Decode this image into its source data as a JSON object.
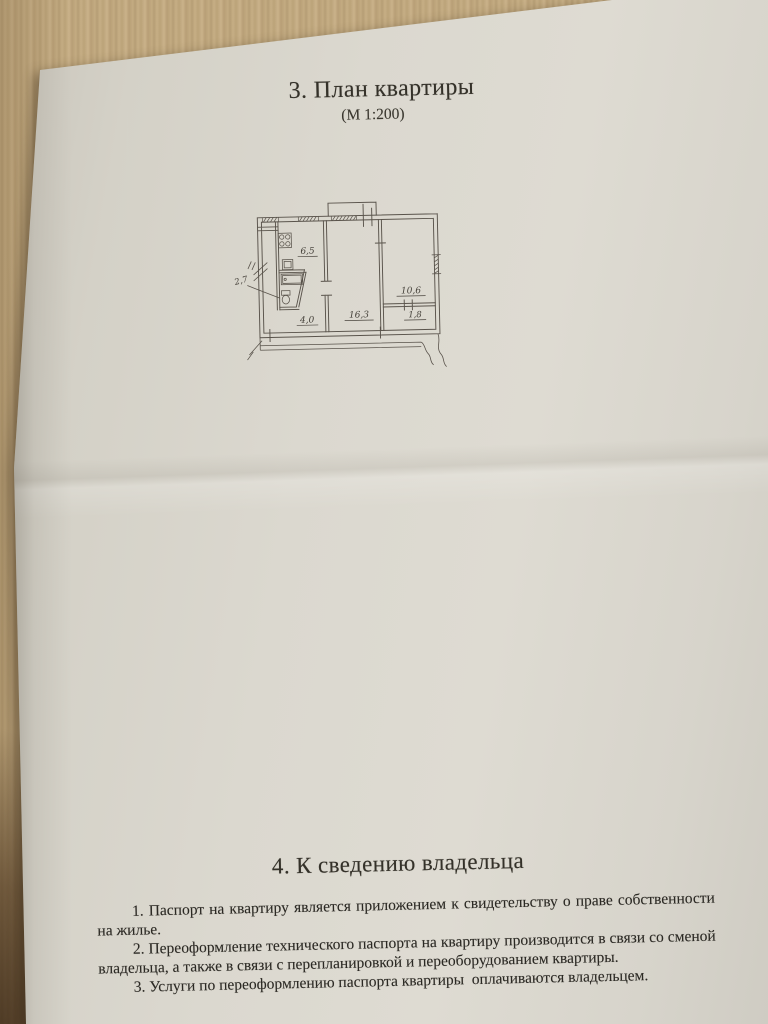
{
  "document": {
    "section_plan": {
      "heading": "3. План квартиры",
      "scale": "(М 1:200)"
    },
    "floor_plan": {
      "rooms": [
        {
          "name": "kitchen",
          "area": "6,5"
        },
        {
          "name": "bathroom",
          "area": "2,7"
        },
        {
          "name": "hallway",
          "area": "4,0"
        },
        {
          "name": "living-room",
          "area": "16,3"
        },
        {
          "name": "bedroom",
          "area": "10,6"
        },
        {
          "name": "storage",
          "area": "1,8"
        }
      ]
    },
    "section_owner": {
      "heading": "4. К сведению владельца",
      "paragraphs": [
        "1. Паспорт на квартиру является приложением к свидетельству о праве собственности на жилье.",
        "2. Переоформление технического паспорта на квартиру производится в связи со сменой владельца, а также в связи с перепланировкой и переоборудованием квартиры.",
        "3. Услуги по переоформлению паспорта квартиры  оплачиваются владельцем."
      ]
    }
  },
  "colors": {
    "paper": "#d8d5cc",
    "wood": "#bfa77e",
    "wood_dark": "#4a3420",
    "ink": "#2f2d28",
    "plan_line": "#59534b"
  }
}
